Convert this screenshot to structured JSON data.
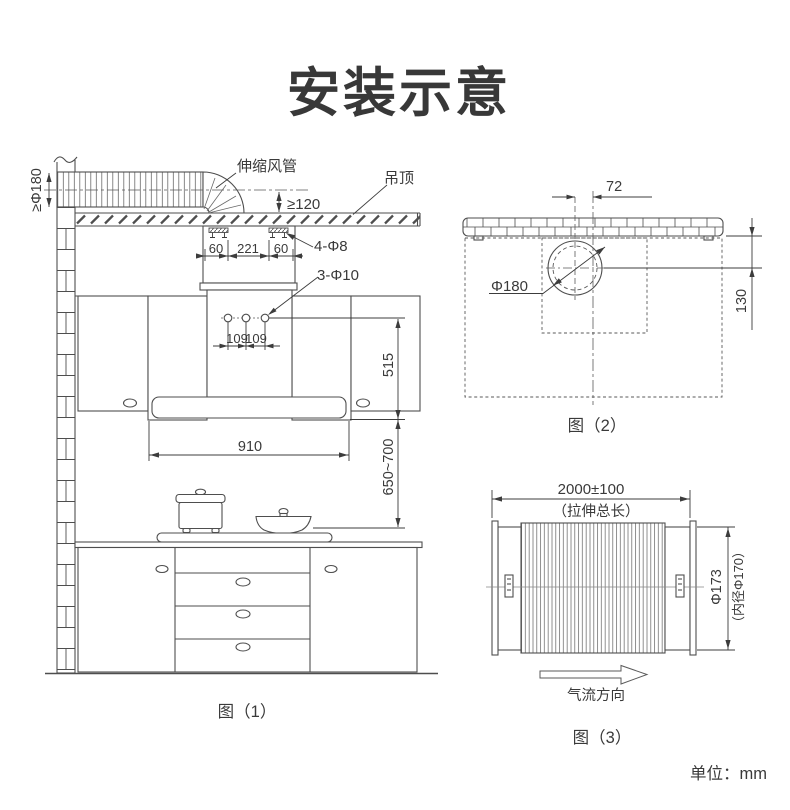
{
  "title": "安装示意",
  "unit_note": "单位：mm",
  "colors": {
    "line": "#4e4e4e",
    "text": "#3a3a3a",
    "background": "#ffffff"
  },
  "fig1": {
    "caption": "图（1）",
    "labels": {
      "flex_duct": "伸缩风管",
      "ceiling": "吊顶",
      "min_duct_diameter": "≥Φ180",
      "min_gap": "≥120",
      "ceiling_holes": "4-Φ8",
      "wall_holes": "3-Φ10"
    },
    "dims": {
      "offset_left": "60",
      "bracket_span": "221",
      "offset_right": "60",
      "hole_gap_1": "109",
      "hole_gap_2": "109",
      "hole_to_bottom": "515",
      "hood_width": "910",
      "bottom_to_cooktop": "650~700"
    }
  },
  "fig2": {
    "caption": "图（2）",
    "dims": {
      "hole_offset": "72",
      "hole_diameter": "Φ180",
      "wall_to_center": "130"
    }
  },
  "fig3": {
    "caption": "图（3）",
    "labels": {
      "airflow": "气流方向"
    },
    "dims": {
      "stretch_length": "2000±100",
      "stretch_note": "（拉伸总长）",
      "outer_diameter": "Φ173",
      "inner_diameter_note": "（内径Φ170）"
    }
  }
}
